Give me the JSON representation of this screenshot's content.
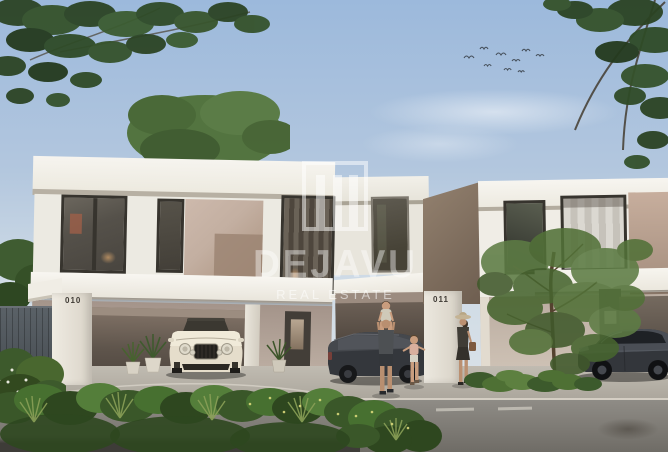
{
  "scene": {
    "type": "real-estate-exterior-render",
    "description": "Modern white two-storey townhouses with carports, a cream luxury car, a dark SUV, a dark sedan, a family with children, a woman walking, a street tree and hedges under a blue sky",
    "units": {
      "left_number": "010",
      "right_number": "011"
    },
    "watermark": {
      "brand": "DEJAVU",
      "tagline": "REAL ESTATE",
      "logo": "square-frame-with-three-bars",
      "color": "#ffffff"
    },
    "palette": {
      "sky": "#9cb9dc",
      "facade_white": "#f2efe8",
      "accent_panel": "#c2ab9c",
      "foliage": "#3d5a2e",
      "luxury_car": "#e8e1d2",
      "dark_vehicle": "#34373c",
      "road": "#86837d"
    }
  }
}
